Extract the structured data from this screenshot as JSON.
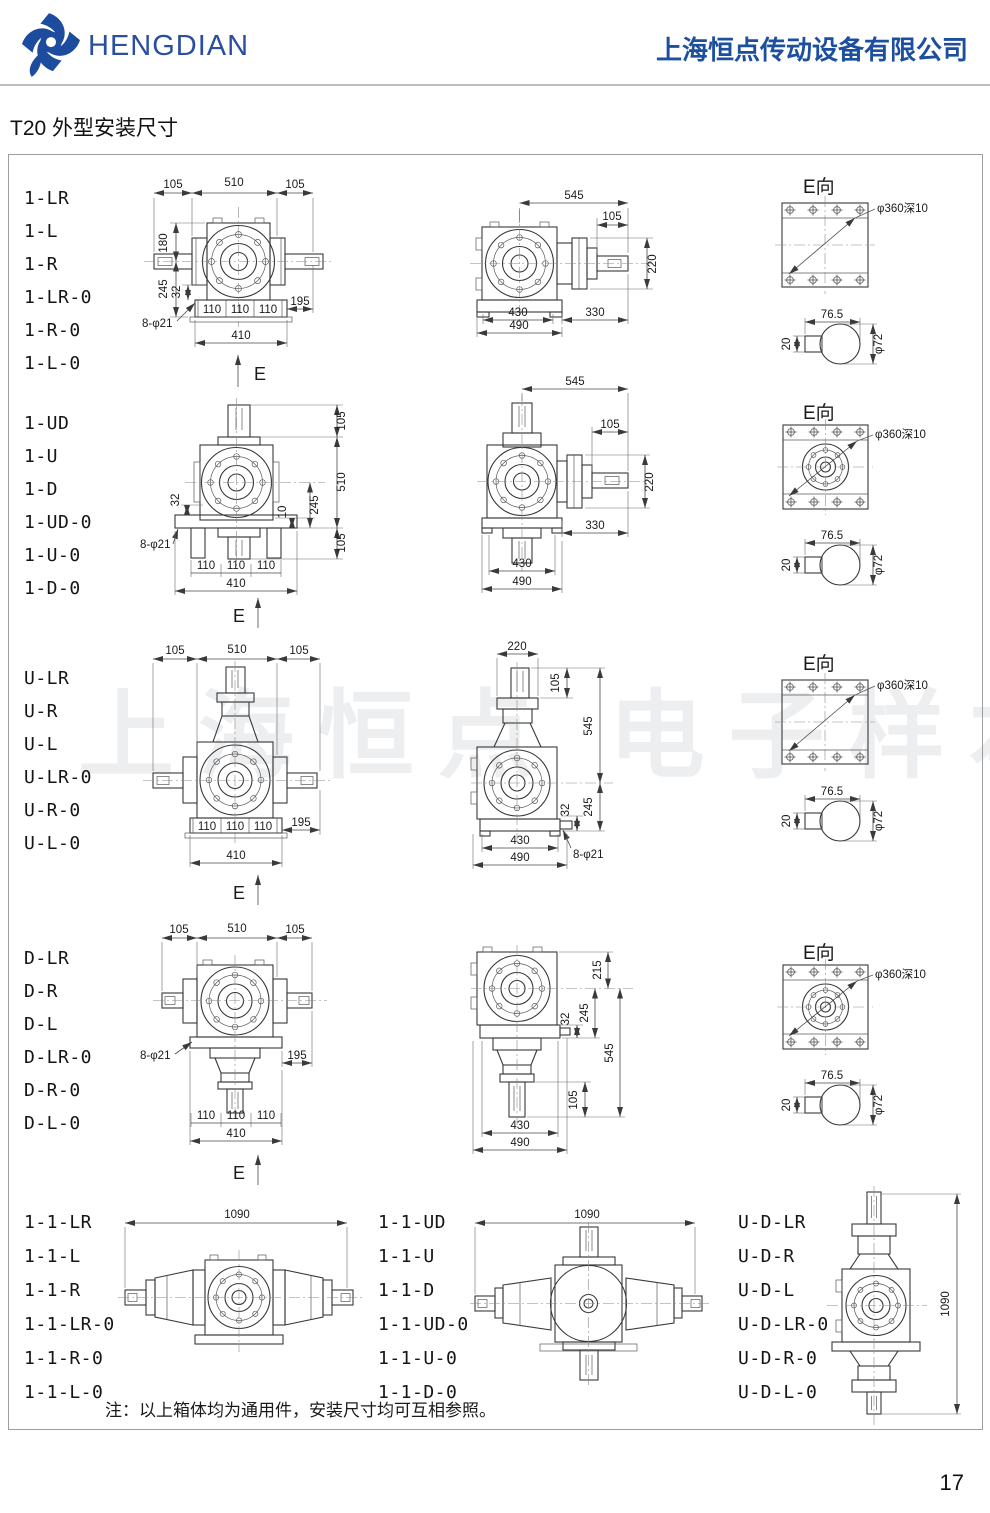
{
  "header": {
    "brand": "HENGDIAN",
    "company": "上海恒点传动设备有限公司",
    "brand_color": "#2a4fa0"
  },
  "page": {
    "title": "T20 外型安装尺寸",
    "page_number": "17",
    "note": "注：以上箱体均为通用件，安装尺寸均可互相参照。",
    "watermark": "上海恒点 电子样本"
  },
  "eview": {
    "title": "E向",
    "thread": "φ360深10",
    "key_width": "76.5",
    "key_depth": "20",
    "shaft_dia": "φ72"
  },
  "rows": [
    {
      "models": [
        "1-LR",
        "1-L",
        "1-R",
        "1-LR-0",
        "1-R-0",
        "1-L-0"
      ],
      "front": {
        "d105a": "105",
        "d510": "510",
        "d105b": "105",
        "d180": "180",
        "d245": "245",
        "d32": "32",
        "holes": "8-φ21",
        "d110a": "110",
        "d110b": "110",
        "d110c": "110",
        "d195": "195",
        "d410": "410",
        "view": "E"
      },
      "side": {
        "d545": "545",
        "d105": "105",
        "d220": "220",
        "d330": "330",
        "d430": "430",
        "d490": "490"
      }
    },
    {
      "models": [
        "1-UD",
        "1-U",
        "1-D",
        "1-UD-0",
        "1-U-0",
        "1-D-0"
      ],
      "front": {
        "d105a": "105",
        "d510": "510",
        "d105b": "105",
        "d10": "10",
        "d245": "245",
        "d32": "32",
        "holes": "8-φ21",
        "d110a": "110",
        "d110b": "110",
        "d110c": "110",
        "d410": "410",
        "view": "E"
      },
      "side": {
        "d545": "545",
        "d105": "105",
        "d220": "220",
        "d330": "330",
        "d430": "430",
        "d490": "490"
      }
    },
    {
      "models": [
        "U-LR",
        "U-R",
        "U-L",
        "U-LR-0",
        "U-R-0",
        "U-L-0"
      ],
      "front": {
        "d105a": "105",
        "d510": "510",
        "d105b": "105",
        "d110a": "110",
        "d110b": "110",
        "d110c": "110",
        "d195": "195",
        "d410": "410",
        "view": "E"
      },
      "side": {
        "d220": "220",
        "d105": "105",
        "d545": "545",
        "d32": "32",
        "d245": "245",
        "holes": "8-φ21",
        "d430": "430",
        "d490": "490"
      }
    },
    {
      "models": [
        "D-LR",
        "D-R",
        "D-L",
        "D-LR-0",
        "D-R-0",
        "D-L-0"
      ],
      "front": {
        "d105a": "105",
        "d510": "510",
        "d105b": "105",
        "holes": "8-φ21",
        "d195": "195",
        "d110a": "110",
        "d110b": "110",
        "d110c": "110",
        "d410": "410",
        "view": "E"
      },
      "side": {
        "d215": "215",
        "d32": "32",
        "d245": "245",
        "d545": "545",
        "d105": "105",
        "d430": "430",
        "d490": "490"
      }
    }
  ],
  "bottom": {
    "groups": [
      {
        "models": [
          "1-1-LR",
          "1-1-L",
          "1-1-R",
          "1-1-LR-0",
          "1-1-R-0",
          "1-1-L-0"
        ],
        "dim": "1090"
      },
      {
        "models": [
          "1-1-UD",
          "1-1-U",
          "1-1-D",
          "1-1-UD-0",
          "1-1-U-0",
          "1-1-D-0"
        ],
        "dim": "1090"
      },
      {
        "models": [
          "U-D-LR",
          "U-D-R",
          "U-D-L",
          "U-D-LR-0",
          "U-D-R-0",
          "U-D-L-0"
        ],
        "dim": "1090"
      }
    ]
  }
}
